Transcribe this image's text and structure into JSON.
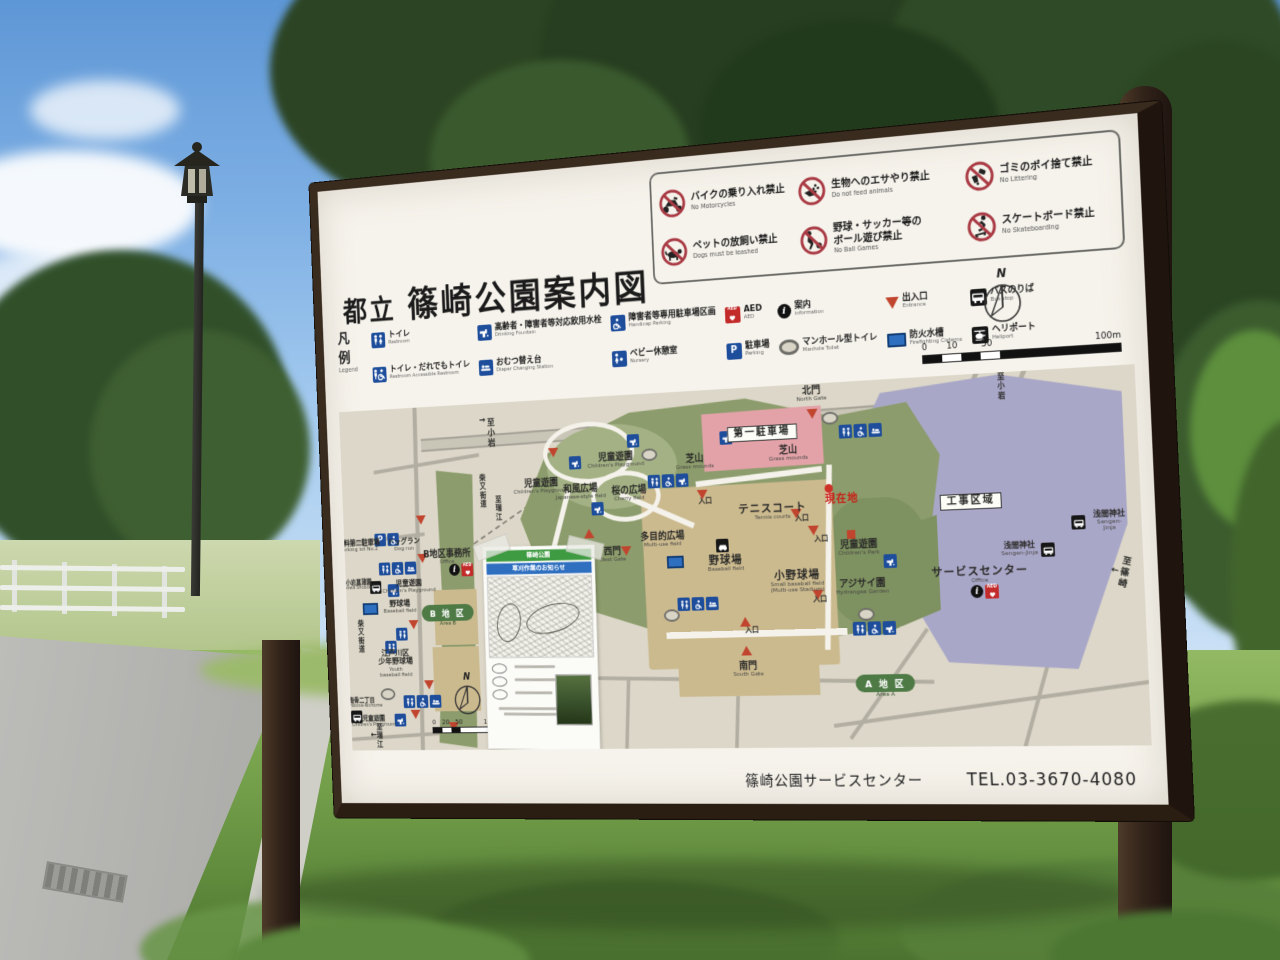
{
  "glyphs": {
    "n": "N",
    "p": "P",
    "i": "i",
    "aed": "AED",
    "arrow_up": "↑",
    "arrow_down": "↓"
  },
  "board": {
    "title_prefix": "都立",
    "title": "篠崎公園案内図",
    "prohibitions": [
      {
        "jp": "バイクの乗り入れ禁止",
        "en": "No Motorcycles",
        "icon": "no-motorcycle-icon"
      },
      {
        "jp": "ペットの放飼い禁止",
        "en": "Dogs must be leashed",
        "icon": "no-loose-pets-icon"
      },
      {
        "jp": "生物へのエサやり禁止",
        "en": "Do not feed animals",
        "icon": "no-feeding-icon"
      },
      {
        "jp": "野球・サッカー等の\nボール遊び禁止",
        "en": "No Ball Games",
        "icon": "no-ball-games-icon"
      },
      {
        "jp": "ゴミのポイ捨て禁止",
        "en": "No Littering",
        "icon": "no-littering-icon"
      },
      {
        "jp": "スケートボード禁止",
        "en": "No Skateboarding",
        "icon": "no-skateboarding-icon"
      }
    ],
    "legend": {
      "heading_jp": "凡例",
      "heading_en": "Legend",
      "items": {
        "toilet": {
          "jp": "トイレ",
          "en": "Restroom"
        },
        "accessible_toilet": {
          "jp": "トイレ・だれでもトイレ",
          "en": "Restroom Accessible Restroom"
        },
        "drinking": {
          "jp": "高齢者・障害者等対応飲用水栓",
          "en": "Drinking Fountain"
        },
        "diaper": {
          "jp": "おむつ替え台",
          "en": "Diaper Changing Station"
        },
        "handicap_parking": {
          "jp": "障害者等専用駐車場区画",
          "en": "Handicap Parking"
        },
        "nursery": {
          "jp": "ベビー休憩室",
          "en": "Nursery"
        },
        "aed": {
          "jp": "AED",
          "en": "AED"
        },
        "parking": {
          "jp": "駐車場",
          "en": "Parking"
        },
        "info": {
          "jp": "案内",
          "en": "information"
        },
        "manhole": {
          "jp": "マンホール型トイレ",
          "en": "Manhole Toilet"
        },
        "entrance": {
          "jp": "出入口",
          "en": "Entrance"
        },
        "cistern": {
          "jp": "防火水槽",
          "en": "Firefighting Cisterns"
        },
        "bus": {
          "jp": "バスのりば",
          "en": "Bus stop"
        },
        "heliport": {
          "jp": "ヘリポート",
          "en": "Heliport"
        }
      }
    },
    "scale1": {
      "t0": "0",
      "t1": "10",
      "t2": "50",
      "t3": "100m"
    },
    "scale2": {
      "t0": "0",
      "t1": "20",
      "t2": "50",
      "t3": "100",
      "t4": "150m"
    },
    "footer": {
      "name": "篠崎公園サービスセンター",
      "tel": "TEL.03-3670-4080"
    },
    "map": {
      "labels": {
        "north_gate": {
          "jp": "北門",
          "en": "North Gate"
        },
        "west_gate": {
          "jp": "西門",
          "en": "West Gate"
        },
        "south_gate": {
          "jp": "南門",
          "en": "South Gate"
        },
        "parking1": {
          "jp": "第一駐車場"
        },
        "shibayama": {
          "jp": "芝山",
          "en": "Grass mounds"
        },
        "childrens_playground": {
          "jp": "児童遊園",
          "en": "Children's Playground"
        },
        "childrens_park": {
          "jp": "児童遊園",
          "en": "Children's Park"
        },
        "wafu": {
          "jp": "和風広場",
          "en": "Japanese-style field"
        },
        "sakura": {
          "jp": "桜の広場",
          "en": "Cherry field"
        },
        "tamokuteki": {
          "jp": "多目的広場",
          "en": "Multi-use field"
        },
        "tennis": {
          "jp": "テニスコート",
          "en": "Tennis courts"
        },
        "genzaichi": {
          "jp": "現在地"
        },
        "baseball": {
          "jp": "野球場",
          "en": "Baseball field"
        },
        "small_baseball": {
          "jp": "小野球場",
          "en": "Small baseball field\n(Multi-use Stadium)"
        },
        "hydrangea": {
          "jp": "アジサイ園",
          "en": "Hydrangea Garden"
        },
        "construction": {
          "jp": "工事区域"
        },
        "sengen": {
          "jp": "浅間神社",
          "en": "Sengen-Jinja"
        },
        "service_center": {
          "jp": "サービスセンター",
          "en": "Office"
        },
        "area_a": {
          "jp": "A 地 区",
          "en": "Area A"
        },
        "area_b": {
          "jp": "B 地 区",
          "en": "Area B"
        },
        "b_office": {
          "jp": "B地区事務所",
          "en": "Office"
        },
        "parking2": {
          "jp": "有料第二駐車場",
          "en": "Parking lot No.2"
        },
        "dog_run": {
          "jp": "ドッグラン",
          "en": "Dog run"
        },
        "youth": {
          "jp": "江戸川区\n少年野球場",
          "en": "Youth\nbaseball field"
        },
        "shishibone": {
          "jp": "鹿骨二丁目",
          "en": "Shishibone-Nichome"
        },
        "koiwa_shobuen": {
          "jp": "小岩菖蒲園",
          "en": "Koiwa Shobuen"
        },
        "entrance": {
          "jp": "入口"
        },
        "to_koiwa": {
          "jp": "至小岩"
        },
        "to_mizue": {
          "jp": "至瑞江"
        },
        "to_shinozaki": {
          "jp": "至篠崎"
        },
        "shibamata": {
          "jp": "柴又街道"
        }
      },
      "notice": {
        "park": "篠崎公園",
        "title": "草刈作業のお知らせ"
      }
    }
  }
}
